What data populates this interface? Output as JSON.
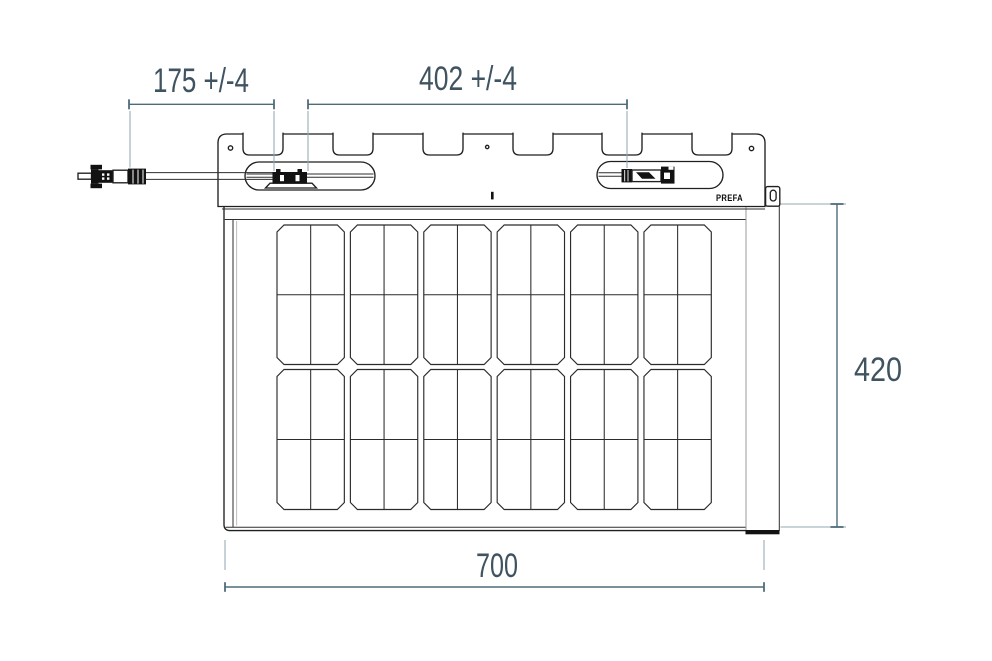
{
  "drawing": {
    "brand_label": "PREFA",
    "dimensions": {
      "cable_length": {
        "label": "175 +/-4"
      },
      "connector_spacing": {
        "label": "402 +/-4"
      },
      "module_height": {
        "label": "420"
      },
      "module_width": {
        "label": "700"
      }
    },
    "grid": {
      "group_columns": 6,
      "group_rows": 2,
      "cell_columns_per_group": 2,
      "cell_rows_per_group": 2
    },
    "colors": {
      "outline": "#1f1f1f",
      "dimension_line": "#4e6b7a",
      "dimension_text": "#3f5360",
      "extension_line": "#93a8b2"
    }
  }
}
